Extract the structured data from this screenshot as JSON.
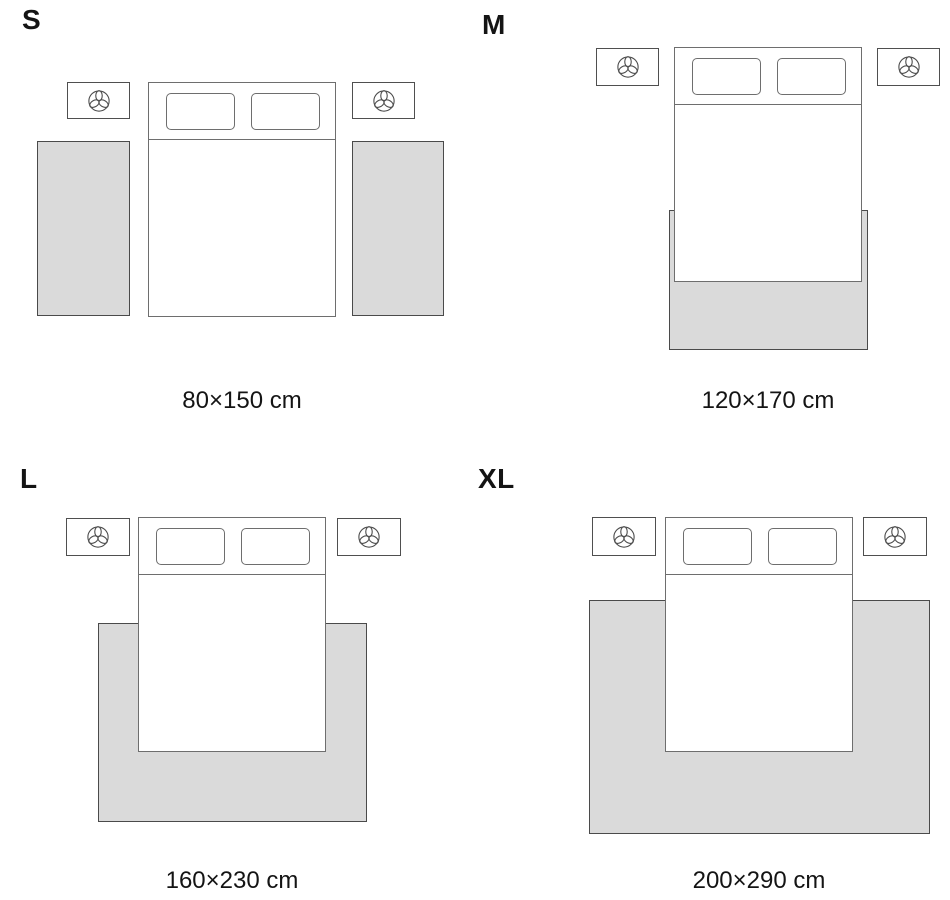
{
  "page": {
    "background": "#ffffff",
    "description_not_rendered": ""
  },
  "colors": {
    "page_bg": "#ffffff",
    "text_color": "#141414",
    "rug_fill": "#dadada",
    "rug_border": "#4a4a4a",
    "furniture_border": "#6e6e6e",
    "nightstand_border": "#4f4f4f"
  },
  "sizes": [
    {
      "label": "S",
      "dimensions": "80×150 cm"
    },
    {
      "label": "M",
      "dimensions": "120×170 cm"
    },
    {
      "label": "L",
      "dimensions": "160×230 cm"
    },
    {
      "label": "XL",
      "dimensions": "200×290 cm"
    }
  ],
  "icons": {
    "nightstand_icon": "plant-icon"
  }
}
